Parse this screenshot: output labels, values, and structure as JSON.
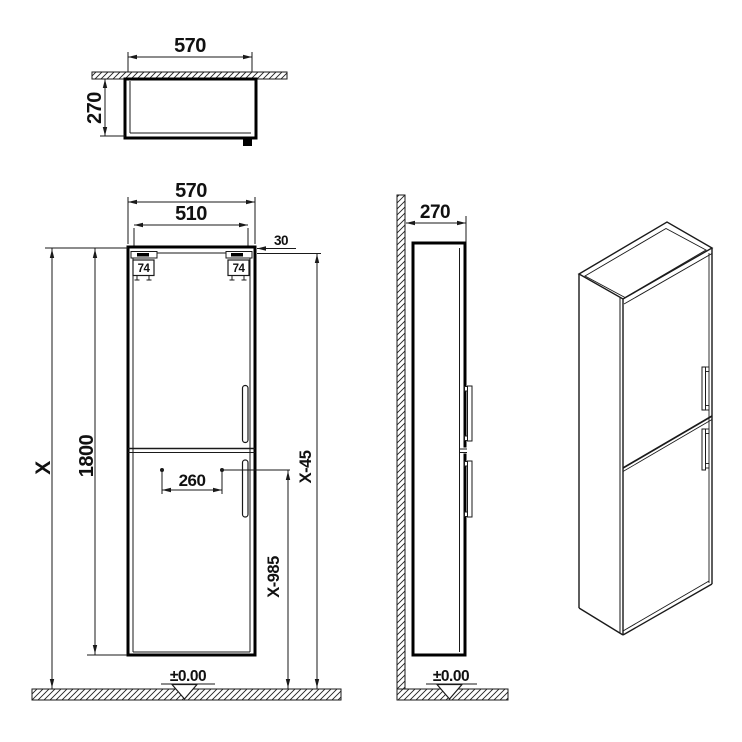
{
  "colors": {
    "line": "#1a1a1a",
    "background": "#ffffff"
  },
  "views": {
    "top": {
      "width": "570",
      "depth": "270"
    },
    "front": {
      "width": "570",
      "door_width": "510",
      "side_offset": "30",
      "hinge_left": "74",
      "hinge_right": "74",
      "cabinet_height": "1800",
      "total_height": "X",
      "handle_offset": "260",
      "upper_handle_level": "X-45",
      "lower_handle_level": "X-985",
      "floor_level": "±0.00"
    },
    "side": {
      "depth": "270",
      "floor_level": "±0.00"
    }
  }
}
